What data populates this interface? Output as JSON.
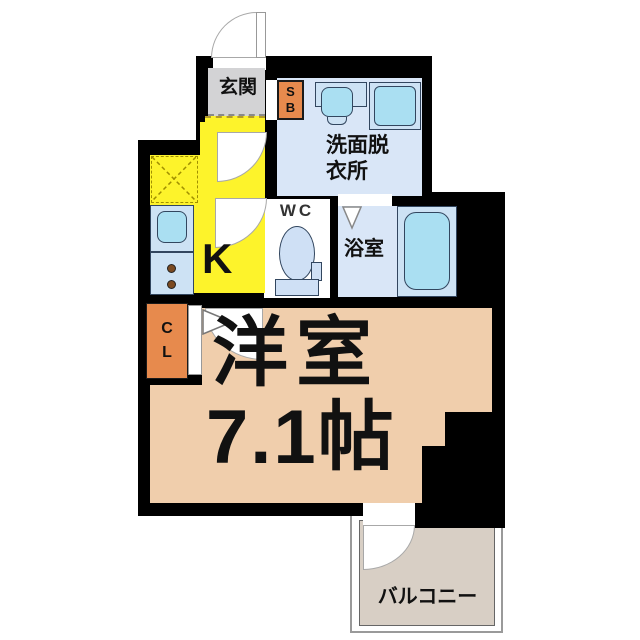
{
  "rooms": {
    "genkan": {
      "label": "玄関"
    },
    "shoe_box": {
      "letters": [
        "S",
        "B"
      ]
    },
    "washroom": {
      "line1": "洗面脱",
      "line2": "衣所"
    },
    "wc": {
      "label": "WC"
    },
    "bath": {
      "label": "浴室"
    },
    "kitchen": {
      "label": "K"
    },
    "closet": {
      "letters": [
        "C",
        "L"
      ]
    },
    "main_room": {
      "name": "洋室",
      "size": "7.1帖"
    },
    "balcony": {
      "label": "バルコニー"
    }
  },
  "colors": {
    "wall": "#000000",
    "genkan_gray": "#d3d3d5",
    "orange_storage": "#e78a4d",
    "room_blue": "#d9e6f7",
    "fixture_panel_blue": "#cde2f4",
    "fixture_cyan": "#aadff2",
    "toilet_blue": "#cfe0f5",
    "kitchen_yellow": "#fdf32b",
    "main_room_peach": "#f0ceac",
    "balcony_gray": "#d8cfc5"
  }
}
